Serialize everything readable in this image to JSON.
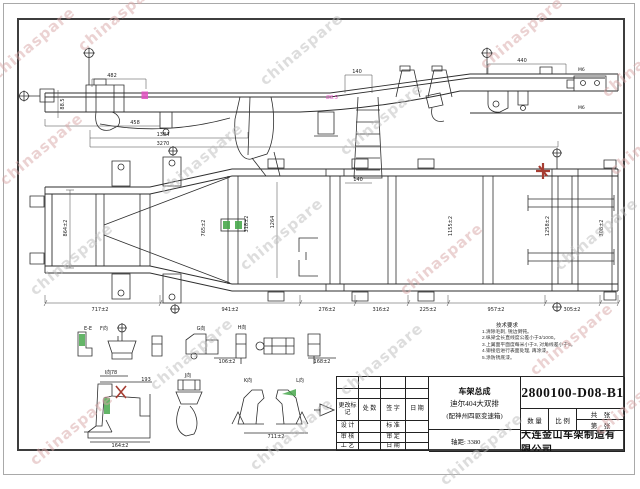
{
  "watermark": {
    "text": "chinaspare"
  },
  "colors": {
    "highlight_green": "#49a84d",
    "highlight_red": "#a63d32",
    "highlight_magenta": "#e04fc1",
    "watermark_pink": "#d9a6a6",
    "watermark_gray": "#bdbdbd"
  },
  "title_block": {
    "drawing_number": "2800100-D08-B1",
    "product_line1": "车架总成",
    "product_line2": "迪尔404大双排",
    "product_line3": "(配神州四驱变速箱)",
    "wheelbase": "轴距: 3380",
    "company": "大连金山车架制造有限公司",
    "qty_label": "数 量",
    "scale_label": "比 例",
    "total_sheets_label": "共　张",
    "sheet_no_label": "第　张",
    "rev": {
      "mark": "更改标记",
      "count": "处 数",
      "sign": "签 字",
      "date": "日 期",
      "design": "设 计",
      "standard": "标 准",
      "check": "审 核",
      "approve": "审 定",
      "process": "工 艺",
      "date2": "日 期"
    }
  },
  "tech_notes": {
    "heading": "技术要求",
    "lines": [
      "1.清除毛刺, 锐边倒钝。",
      "2.纵梁全长直线度公差小于3/1000。",
      "3.上翼面平面度每米小于3, 对角线差小于5。",
      "4.铆接后进行表面处理, 再涂漆。",
      "5.涂防锈底漆。"
    ]
  },
  "dims": {
    "side": [
      "482",
      "140",
      "440",
      "458",
      "88.5",
      "1384",
      "3270"
    ],
    "side_note": "Ø8.5",
    "m6": "M6",
    "plan_top": "140",
    "plan_vertical": [
      "864±2",
      "765±2",
      "318±2",
      "1264",
      "1155±2",
      "1258±2",
      "308±2"
    ],
    "plan_bottom": [
      "717±2",
      "941±2",
      "276±2",
      "316±2",
      "225±2",
      "957±2",
      "305±2"
    ],
    "details": [
      "78",
      "193",
      "164±2",
      "711±2",
      "106±2",
      "168±2"
    ]
  },
  "detail_views": {
    "row1": [
      "E-E",
      "F向",
      "G向",
      "H向"
    ],
    "row2": [
      "I向",
      "J向",
      "K向",
      "L向"
    ]
  }
}
